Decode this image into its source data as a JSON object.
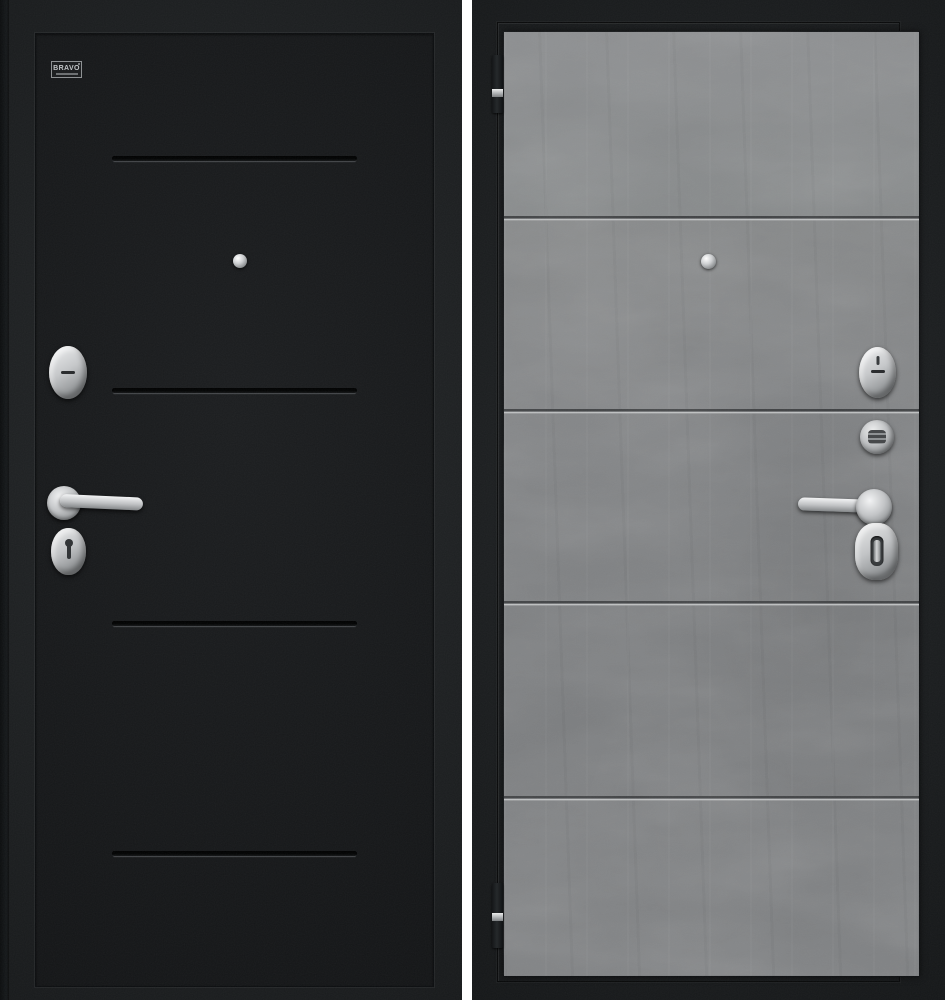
{
  "brand": {
    "badge_label": "BRAVO"
  },
  "product": {
    "left_door_side": "exterior-black-textured",
    "right_door_side": "interior-gray-concrete",
    "panel_bands_right": 5,
    "groove_lines_left": 4,
    "seam_lines_right": 4
  },
  "hardware": {
    "left": [
      "brand-badge",
      "peephole",
      "lock-cylinder-cover",
      "handle-rosette",
      "lever-handle",
      "keyhole-escutcheon"
    ],
    "right": [
      "hinge-top",
      "peephole",
      "lock-cylinder-cover",
      "night-latch-cylinder",
      "handle-rosette",
      "lever-handle",
      "thumbturn-escutcheon",
      "hinge-bottom"
    ]
  },
  "colors": {
    "background": "#ffffff",
    "door_black": "#1c1f21",
    "door_black_panel": "#17191b",
    "door_frame": "#1a1d1f",
    "concrete_panel": "#828486",
    "groove_dark": "#0a0c0d",
    "groove_light": "#44484b",
    "line_dark": "#3d3f41",
    "line_light": "#c0c2c3",
    "hardware_silver": "#c9cbcd"
  }
}
